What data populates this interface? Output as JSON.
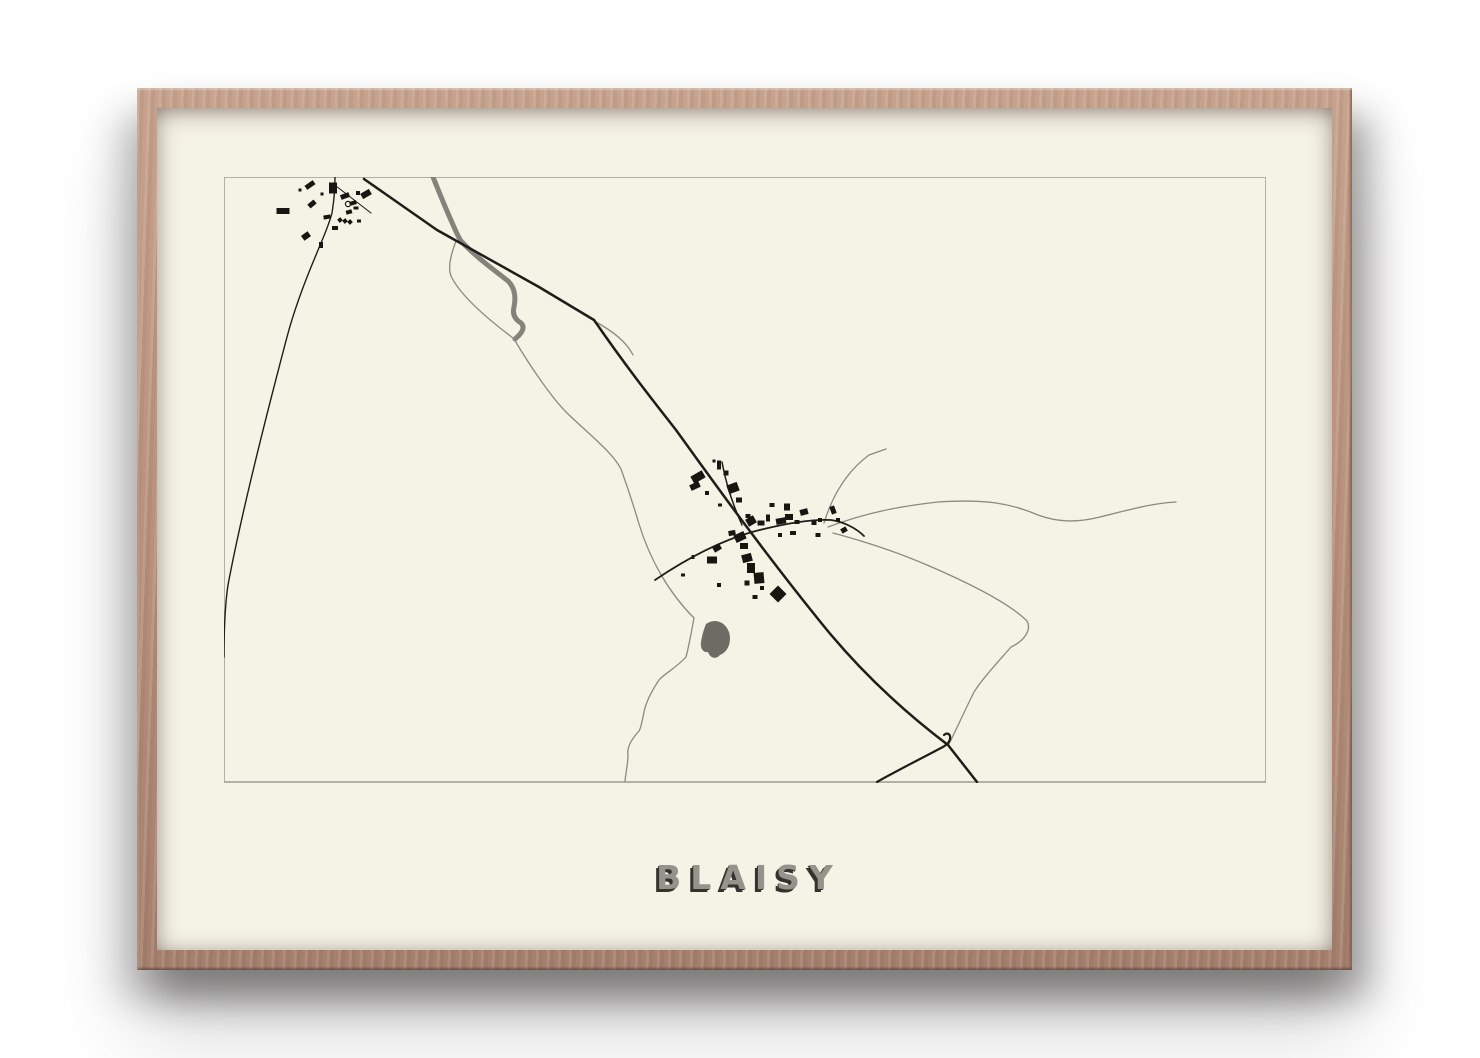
{
  "poster": {
    "title": "BLAISY"
  },
  "theme": {
    "wood-light": "#c7a28c",
    "wood-mid": "#b78f7b",
    "wood-dark": "#a57f6d",
    "paper": "#f5f2e6",
    "title-fill": "#95938b",
    "title-shadow": "#33322c"
  },
  "map": {
    "viewbox": "224 177 1042 606",
    "border": {
      "x": 224,
      "y": 177,
      "w": 1042,
      "h": 605,
      "color": "#a19f97",
      "stroke_width": 1.6
    },
    "colors": {
      "major": "#1e1d1a",
      "minor": "#8b8a81",
      "thick": "#84837b",
      "building": "#171611",
      "water": "#6e6d65"
    },
    "roads": [
      {
        "kind": "thick",
        "width": 5,
        "d": "M433,177 C441,197 449,216 454,227 C457,234 459,238 461,241 C478,259 497,272 508,281 C515,288 516,297 514,307 C512,315 516,320 521,323 C526,328 521,334 515,339"
      },
      {
        "kind": "minor",
        "width": 1.3,
        "d": "M456,241 C450,257 448,268 451,276 C460,295 485,317 513,338"
      },
      {
        "kind": "minor",
        "width": 1.3,
        "d": "M514,339 C533,371 553,399 567,413 C591,436 612,452 621,469 C629,491 634,507 639,524 C650,560 669,593 694,618 C691,634 689,646 686,657 C676,668 664,674 659,680 C651,692 646,702 644,712 C642,722 641,728 639,731 C630,741 627,748 628,755 C628,763 626,772 625,781"
      },
      {
        "kind": "minor",
        "width": 1.3,
        "d": "M594,321 C615,332 627,343 633,355"
      },
      {
        "kind": "minor",
        "width": 1.3,
        "d": "M828,527 C868,512 902,506 938,502 C985,499 1010,503 1038,515 C1057,522 1076,523 1100,517 C1132,509 1154,503 1176,502"
      },
      {
        "kind": "minor",
        "width": 1.3,
        "d": "M833,533 C863,541 897,552 927,565 C962,580 1007,601 1027,621 C1032,630 1024,641 1011,647 C997,663 983,678 974,692 C966,708 957,728 949,744"
      },
      {
        "kind": "minor",
        "width": 1.3,
        "d": "M824,523 C832,497 846,472 869,455 L886,449"
      },
      {
        "kind": "major",
        "width": 2.5,
        "d": "M364,179 L437,230 L539,287 L594,320 C630,372 655,403 676,430 C700,463 760,548 827,630 C870,682 915,720 948,745 L977,782"
      },
      {
        "kind": "major",
        "width": 2.2,
        "d": "M877,782 C898,770 926,756 941,748 C947,745 951,741 950,736 C949,733 946,733 944,735"
      },
      {
        "kind": "major",
        "width": 1.8,
        "d": "M655,580 C692,555 724,540 752,532 C786,523 813,519 831,520 C845,522 857,529 864,536"
      },
      {
        "kind": "major",
        "width": 1.5,
        "d": "M742,525 C733,505 727,487 723,467 L722,462"
      },
      {
        "kind": "major",
        "width": 1.4,
        "d": "M335,177 C335,196 333,206 332,213 C328,228 322,240 316,255 C300,293 292,318 287,337 C273,390 243,505 228,585 C225,605 224,635 224,657"
      },
      {
        "kind": "major",
        "width": 1.1,
        "d": "M336,186 L371,213"
      }
    ],
    "pond": "M706,624 C714,618 725,621 729,632 C732,642 728,652 720,655 C716,660 710,658 708,652 C703,653 700,648 701,642 C702,635 704,629 706,624 Z",
    "church_marker": {
      "cx": 348,
      "cy": 204,
      "r": 2.6
    },
    "buildings": [
      [
        310,
        185,
        10,
        5,
        -35
      ],
      [
        333,
        188,
        8,
        11,
        0
      ],
      [
        322,
        194,
        3,
        3,
        0
      ],
      [
        345,
        196,
        9,
        5,
        -20
      ],
      [
        358,
        193,
        4,
        4,
        0
      ],
      [
        366,
        194,
        10,
        6,
        -30
      ],
      [
        312,
        204,
        8,
        5,
        -40
      ],
      [
        283,
        211,
        13,
        6,
        0
      ],
      [
        353,
        203,
        7,
        4,
        -15
      ],
      [
        327,
        217,
        7,
        4,
        -10
      ],
      [
        340,
        220,
        4,
        4,
        -40
      ],
      [
        345,
        221,
        4,
        4,
        -40
      ],
      [
        350,
        222,
        4,
        4,
        -40
      ],
      [
        349,
        212,
        6,
        4,
        -15
      ],
      [
        356,
        208,
        5,
        3,
        0
      ],
      [
        335,
        228,
        6,
        4,
        0
      ],
      [
        306,
        236,
        8,
        6,
        -35
      ],
      [
        321,
        245,
        4,
        6,
        0
      ],
      [
        300,
        190,
        3,
        3,
        0
      ],
      [
        359,
        221,
        4,
        3,
        0
      ],
      [
        698,
        477,
        13,
        8,
        -30
      ],
      [
        719,
        465,
        4,
        9,
        0
      ],
      [
        726,
        473,
        5,
        5,
        0
      ],
      [
        695,
        486,
        10,
        6,
        -25
      ],
      [
        707,
        493,
        4,
        4,
        0
      ],
      [
        733,
        488,
        11,
        9,
        -20
      ],
      [
        739,
        500,
        6,
        5,
        0
      ],
      [
        720,
        505,
        4,
        3,
        0
      ],
      [
        748,
        516,
        5,
        4,
        0
      ],
      [
        751,
        521,
        9,
        8,
        -30
      ],
      [
        761,
        523,
        7,
        5,
        0
      ],
      [
        768,
        518,
        4,
        7,
        0
      ],
      [
        772,
        505,
        5,
        4,
        0
      ],
      [
        787,
        507,
        6,
        7,
        0
      ],
      [
        789,
        517,
        8,
        6,
        0
      ],
      [
        781,
        521,
        10,
        6,
        -10
      ],
      [
        797,
        522,
        5,
        4,
        0
      ],
      [
        804,
        512,
        8,
        6,
        -15
      ],
      [
        814,
        523,
        5,
        4,
        0
      ],
      [
        820,
        520,
        4,
        4,
        0
      ],
      [
        833,
        510,
        5,
        8,
        -20
      ],
      [
        838,
        520,
        4,
        4,
        0
      ],
      [
        844,
        530,
        6,
        5,
        -30
      ],
      [
        818,
        535,
        5,
        4,
        0
      ],
      [
        793,
        533,
        6,
        4,
        0
      ],
      [
        780,
        535,
        4,
        4,
        0
      ],
      [
        740,
        537,
        11,
        8,
        -25
      ],
      [
        744,
        546,
        8,
        6,
        0
      ],
      [
        732,
        533,
        7,
        5,
        -10
      ],
      [
        717,
        548,
        8,
        6,
        -30
      ],
      [
        712,
        560,
        10,
        7,
        0
      ],
      [
        693,
        557,
        3,
        4,
        0
      ],
      [
        683,
        575,
        4,
        3,
        0
      ],
      [
        747,
        558,
        10,
        8,
        -15
      ],
      [
        751,
        568,
        8,
        10,
        0
      ],
      [
        759,
        578,
        10,
        11,
        -5
      ],
      [
        747,
        583,
        5,
        5,
        0
      ],
      [
        762,
        588,
        4,
        4,
        0
      ],
      [
        778,
        594,
        12,
        12,
        -45
      ],
      [
        719,
        585,
        4,
        4,
        0
      ],
      [
        755,
        597,
        5,
        4,
        0
      ],
      [
        714,
        461,
        3,
        3,
        0
      ]
    ]
  }
}
